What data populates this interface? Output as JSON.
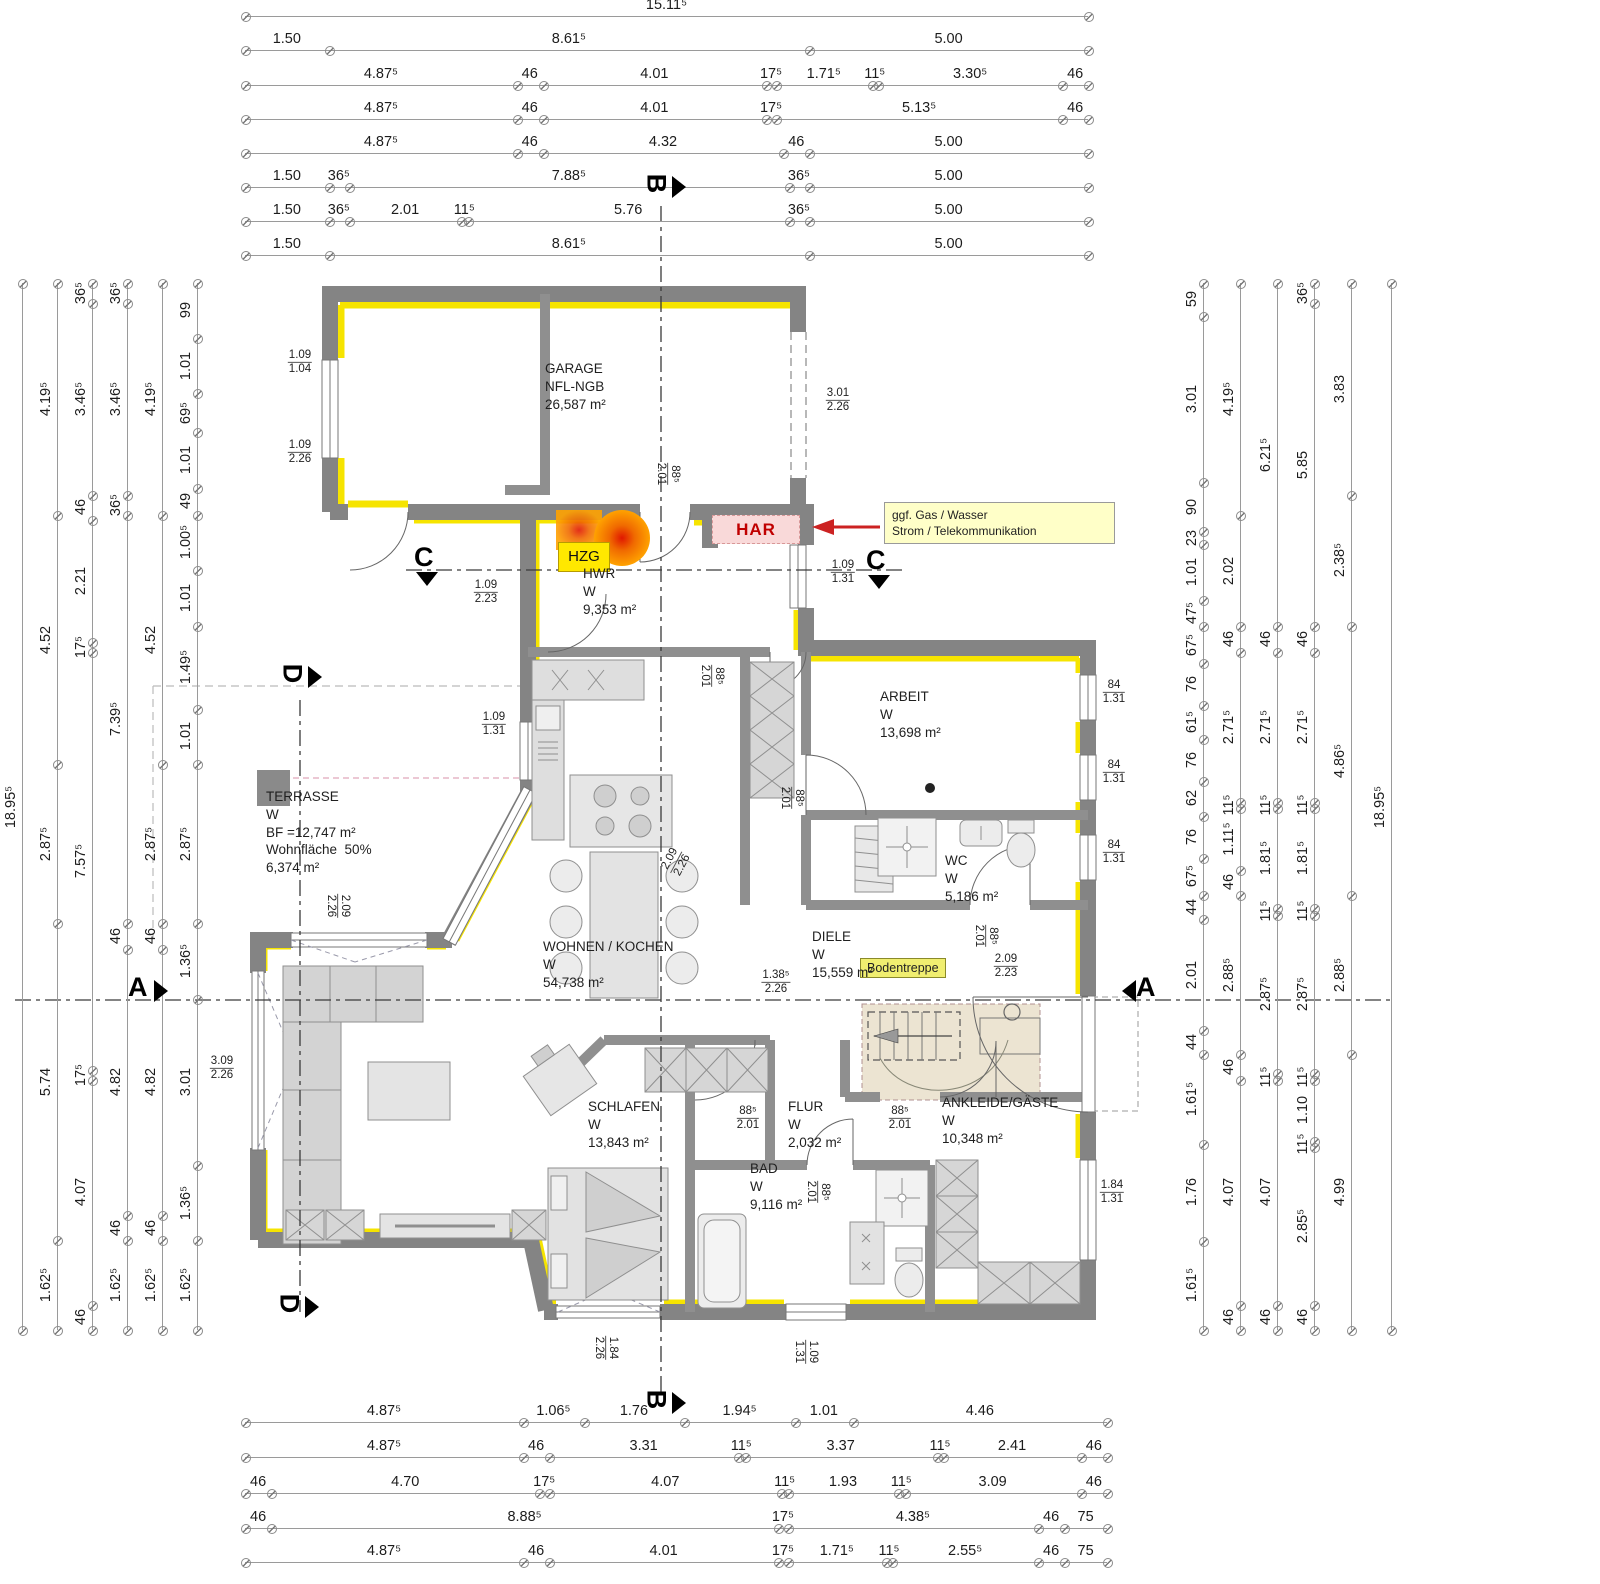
{
  "colors": {
    "wall": "#848484",
    "partition": "#8f8f8f",
    "insulation": "#f6e400",
    "furniture_fill": "#dedede",
    "furniture_stroke": "#8f8f8f",
    "stair_fill": "#ece4d2",
    "har_red": "#c00000",
    "note_yellow": "#ffffc8",
    "hzg_yellow": "#ffe800",
    "section_line": "#3a3a3a"
  },
  "dims": {
    "top": {
      "x0": 245,
      "len": 843,
      "rows": [
        {
          "y": 16,
          "labels": [
            "15.11⁵"
          ]
        },
        {
          "y": 50,
          "labels": [
            "1.50",
            "8.61⁵",
            "5.00"
          ]
        },
        {
          "y": 85,
          "labels": [
            "4.87⁵",
            "46",
            "4.01",
            "17⁵",
            "1.71⁵",
            "11⁵",
            "3.30⁵",
            "46"
          ]
        },
        {
          "y": 119,
          "labels": [
            "4.87⁵",
            "46",
            "4.01",
            "17⁵",
            "5.13⁵",
            "46"
          ]
        },
        {
          "y": 153,
          "labels": [
            "4.87⁵",
            "46",
            "4.32",
            "46",
            "5.00"
          ]
        },
        {
          "y": 187,
          "labels": [
            "1.50",
            "36⁵",
            "7.88⁵",
            "36⁵",
            "5.00"
          ]
        },
        {
          "y": 221,
          "labels": [
            "1.50",
            "36⁵",
            "2.01",
            "11⁵",
            "5.76",
            "36⁵",
            "5.00"
          ]
        },
        {
          "y": 255,
          "labels": [
            "1.50",
            "8.61⁵",
            "5.00"
          ]
        }
      ]
    },
    "bottom": {
      "x0": 245,
      "len": 862,
      "rows": [
        {
          "y": 1422,
          "labels": [
            "4.87⁵",
            "1.06⁵",
            "1.76",
            "1.94⁵",
            "1.01",
            "4.46"
          ]
        },
        {
          "y": 1457,
          "labels": [
            "4.87⁵",
            "46",
            "3.31",
            "11⁵",
            "3.37",
            "11⁵",
            "2.41",
            "46"
          ]
        },
        {
          "y": 1493,
          "labels": [
            "46",
            "4.70",
            "17⁵",
            "4.07",
            "11⁵",
            "1.93",
            "11⁵",
            "3.09",
            "46"
          ]
        },
        {
          "y": 1528,
          "labels": [
            "46",
            "8.88⁵",
            "17⁵",
            "4.38⁵",
            "46",
            "75"
          ]
        },
        {
          "y": 1562,
          "labels": [
            "4.87⁵",
            "46",
            "4.01",
            "17⁵",
            "1.71⁵",
            "11⁵",
            "2.55⁵",
            "46",
            "75"
          ]
        }
      ]
    },
    "left": {
      "y0": 283,
      "len": 1047,
      "cols": [
        {
          "x": 22,
          "labels": [
            "18.95⁵"
          ]
        },
        {
          "x": 57,
          "labels": [
            "4.19⁵",
            "4.52",
            "2.87⁵",
            "5.74",
            "1.62⁵"
          ]
        },
        {
          "x": 92,
          "labels": [
            "36⁵",
            "3.46⁵",
            "46",
            "2.21",
            "17⁵",
            "7.57⁵",
            "17⁵",
            "4.07",
            "46"
          ]
        },
        {
          "x": 127,
          "labels": [
            "36⁵",
            "3.46⁵",
            "36⁵",
            "7.39⁵",
            "46",
            "4.82",
            "46",
            "1.62⁵"
          ]
        },
        {
          "x": 162,
          "labels": [
            "4.19⁵",
            "4.52",
            "2.87⁵",
            "46",
            "4.82",
            "46",
            "1.62⁵"
          ]
        },
        {
          "x": 197,
          "labels": [
            "99",
            "1.01",
            "69⁵",
            "1.01",
            "49",
            "1.00⁵",
            "1.01",
            "1.49⁵",
            "1.01",
            "2.87⁵",
            "1.36⁵",
            "3.01",
            "1.36⁵",
            "1.62⁵"
          ]
        }
      ]
    },
    "right": {
      "y0": 283,
      "len": 1047,
      "cols": [
        {
          "x": 1203,
          "labels": [
            "59",
            "3.01",
            "90",
            "23",
            "1.01",
            "47⁵",
            "67⁵",
            "76",
            "61⁵",
            "76",
            "62",
            "76",
            "67⁵",
            "44",
            "2.01",
            "44",
            "1.61⁵",
            "1.76",
            "1.61⁵"
          ]
        },
        {
          "x": 1240,
          "labels": [
            "4.19⁵",
            "2.02",
            "46",
            "2.71⁵",
            "11⁵",
            "1.11⁵",
            "46",
            "2.88⁵",
            "46",
            "4.07",
            "46"
          ]
        },
        {
          "x": 1277,
          "labels": [
            "6.21⁵",
            "46",
            "2.71⁵",
            "11⁵",
            "1.81⁵",
            "11⁵",
            "2.87⁵",
            "11⁵",
            "4.07",
            "46"
          ]
        },
        {
          "x": 1314,
          "labels": [
            "36⁵",
            "5.85",
            "46",
            "2.71⁵",
            "11⁵",
            "1.81⁵",
            "11⁵",
            "2.87⁵",
            "11⁵",
            "1.10",
            "11⁵",
            "2.85⁵",
            "46"
          ]
        },
        {
          "x": 1351,
          "labels": [
            "3.83",
            "2.38⁵",
            "4.86⁵",
            "2.88⁵",
            "4.99"
          ]
        },
        {
          "x": 1391,
          "labels": [
            "18.95⁵"
          ]
        }
      ]
    }
  },
  "rooms": [
    {
      "id": "garage",
      "x": 545,
      "y": 360,
      "lines": [
        "GARAGE",
        "NFL-NGB",
        "26,587 m²"
      ]
    },
    {
      "id": "hwr",
      "x": 583,
      "y": 565,
      "lines": [
        "HWR",
        "W",
        "9,353 m²"
      ]
    },
    {
      "id": "arbeit",
      "x": 880,
      "y": 688,
      "lines": [
        "ARBEIT",
        "W",
        "13,698 m²"
      ]
    },
    {
      "id": "wc",
      "x": 945,
      "y": 852,
      "lines": [
        "WC",
        "W",
        "5,186 m²"
      ]
    },
    {
      "id": "diele",
      "x": 812,
      "y": 928,
      "lines": [
        "DIELE",
        "W",
        "15,559 m²"
      ]
    },
    {
      "id": "terrasse",
      "x": 266,
      "y": 788,
      "lines": [
        "TERRASSE",
        "W",
        "BF =12,747 m²",
        "Wohnfläche  50%",
        "6,374 m²"
      ]
    },
    {
      "id": "wohnen-kochen",
      "x": 543,
      "y": 938,
      "lines": [
        "WOHNEN / KOCHEN",
        "W",
        "54,738 m²"
      ]
    },
    {
      "id": "schlafen",
      "x": 588,
      "y": 1098,
      "lines": [
        "SCHLAFEN",
        "W",
        "13,843 m²"
      ]
    },
    {
      "id": "bad",
      "x": 750,
      "y": 1160,
      "lines": [
        "BAD",
        "W",
        "9,116 m²"
      ]
    },
    {
      "id": "flur",
      "x": 788,
      "y": 1098,
      "lines": [
        "FLUR",
        "W",
        "2,032 m²"
      ]
    },
    {
      "id": "ankleide-gaeste",
      "x": 942,
      "y": 1094,
      "lines": [
        "ANKLEIDE/GÄSTE",
        "W",
        "10,348 m²"
      ]
    }
  ],
  "openings": [
    {
      "t": "1.09",
      "b": "1.04",
      "x": 300,
      "y": 362,
      "rot": 0
    },
    {
      "t": "1.09",
      "b": "2.26",
      "x": 300,
      "y": 452,
      "rot": 0
    },
    {
      "t": "3.01",
      "b": "2.26",
      "x": 838,
      "y": 400,
      "rot": 0
    },
    {
      "t": "88⁵",
      "b": "2.01",
      "x": 668,
      "y": 474,
      "rot": 90
    },
    {
      "t": "1.09",
      "b": "1.31",
      "x": 843,
      "y": 572,
      "rot": 0
    },
    {
      "t": "1.09",
      "b": "2.23",
      "x": 486,
      "y": 592,
      "rot": 0
    },
    {
      "t": "88⁵",
      "b": "2.01",
      "x": 712,
      "y": 676,
      "rot": 90
    },
    {
      "t": "1.09",
      "b": "1.31",
      "x": 494,
      "y": 724,
      "rot": 0
    },
    {
      "t": "84",
      "b": "1.31",
      "x": 1114,
      "y": 692,
      "rot": 0
    },
    {
      "t": "84",
      "b": "1.31",
      "x": 1114,
      "y": 772,
      "rot": 0
    },
    {
      "t": "84",
      "b": "1.31",
      "x": 1114,
      "y": 852,
      "rot": 0
    },
    {
      "t": "88⁵",
      "b": "2.01",
      "x": 792,
      "y": 798,
      "rot": 90
    },
    {
      "t": "2.09",
      "b": "2.26",
      "x": 676,
      "y": 862,
      "rot": -62
    },
    {
      "t": "2.09",
      "b": "2.26",
      "x": 338,
      "y": 906,
      "rot": 90
    },
    {
      "t": "88⁵",
      "b": "2.01",
      "x": 986,
      "y": 936,
      "rot": 90
    },
    {
      "t": "1.38⁵",
      "b": "2.26",
      "x": 776,
      "y": 982,
      "rot": 0
    },
    {
      "t": "2.09",
      "b": "2.23",
      "x": 1006,
      "y": 966,
      "rot": 0
    },
    {
      "t": "3.09",
      "b": "2.26",
      "x": 222,
      "y": 1068,
      "rot": 0
    },
    {
      "t": "88⁵",
      "b": "2.01",
      "x": 748,
      "y": 1118,
      "rot": 0
    },
    {
      "t": "88⁵",
      "b": "2.01",
      "x": 900,
      "y": 1118,
      "rot": 0
    },
    {
      "t": "88⁵",
      "b": "2.01",
      "x": 818,
      "y": 1192,
      "rot": 90
    },
    {
      "t": "1.84",
      "b": "1.31",
      "x": 1112,
      "y": 1192,
      "rot": 0
    },
    {
      "t": "1.84",
      "b": "2.26",
      "x": 606,
      "y": 1348,
      "rot": 90
    },
    {
      "t": "1.09",
      "b": "1.31",
      "x": 806,
      "y": 1352,
      "rot": 90
    }
  ],
  "markers": [
    {
      "label": "B",
      "x": 646,
      "y": 168,
      "rot": 90,
      "tri": "right"
    },
    {
      "label": "B",
      "x": 646,
      "y": 1384,
      "rot": 90,
      "tri": "right"
    },
    {
      "label": "C",
      "x": 414,
      "y": 542,
      "rot": 0,
      "tri": "down"
    },
    {
      "label": "C",
      "x": 866,
      "y": 545,
      "rot": 0,
      "tri": "down"
    },
    {
      "label": "A",
      "x": 128,
      "y": 972,
      "rot": 0,
      "tri": "right"
    },
    {
      "label": "A",
      "x": 1136,
      "y": 972,
      "rot": 0,
      "tri": "left"
    },
    {
      "label": "D",
      "x": 282,
      "y": 658,
      "rot": 90,
      "tri": "right"
    },
    {
      "label": "D",
      "x": 279,
      "y": 1288,
      "rot": 90,
      "tri": "right"
    }
  ],
  "annotations": {
    "har": "HAR",
    "hzg": "HZG",
    "bodentreppe": "Bodentreppe",
    "utility_note_line1": "ggf. Gas / Wasser",
    "utility_note_line2": "Strom / Telekommunikation"
  }
}
